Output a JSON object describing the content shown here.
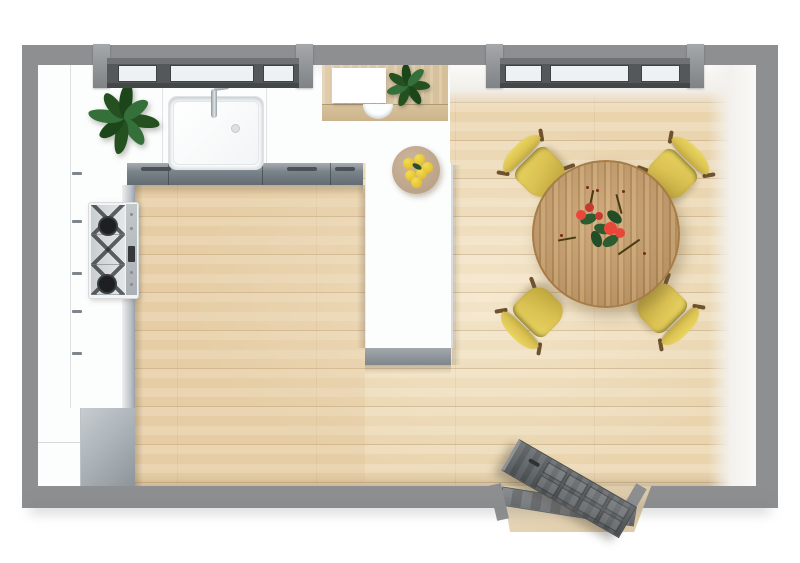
{
  "scene": {
    "name": "kitchen-dining-room-floor-plan",
    "view": "3d-top-down-render",
    "background": "#ffffff"
  },
  "palette": {
    "wall": "#8d8f91",
    "window_frame": "#54585a",
    "window_pane": "#eef1f2",
    "floor_base": "#e9d4ae",
    "counter": "#fcfdfd",
    "cabinet_front": "#7b838a",
    "appliance_gray": "#aeb5ba",
    "desk_wood": "#dcc7a2",
    "paper_white": "#ffffff",
    "stove_white": "#f2f4f5",
    "burner_black": "#1d1f21",
    "display_dark": "#34383a",
    "sink_white": "#feffff",
    "faucet_chrome": "#a7adb2",
    "plant_dark": "#24511f",
    "plant_mid": "#35703a",
    "table_wood": "#c59a66",
    "table_stripe": "#b0854e",
    "chair_yellow": "#dcc354",
    "chair_leg_brown": "#6f532f",
    "flower_red": "#e8473a",
    "leaf_green": "#2c5c2f",
    "lemon_yellow": "#e4c12f",
    "plate_tan": "#c2ab92",
    "door_gray": "#5c6164",
    "threshold_gray": "#6a6e72"
  },
  "windows": {
    "left_pane_count": 3,
    "right_pane_count": 3
  },
  "furniture": {
    "dining_chairs_count": 4,
    "items": [
      "dining-table",
      "dining-chair-nw",
      "dining-chair-ne",
      "dining-chair-sw",
      "dining-chair-se",
      "kitchen-sink",
      "faucet",
      "stove-cooktop",
      "corner-plant",
      "desk-plant",
      "fruit-plate",
      "entry-door",
      "kitchen-counter-run",
      "kitchen-peninsula",
      "wall-window-left",
      "wall-window-right",
      "console-desk",
      "desk-stool",
      "base-cabinet-gray"
    ]
  }
}
